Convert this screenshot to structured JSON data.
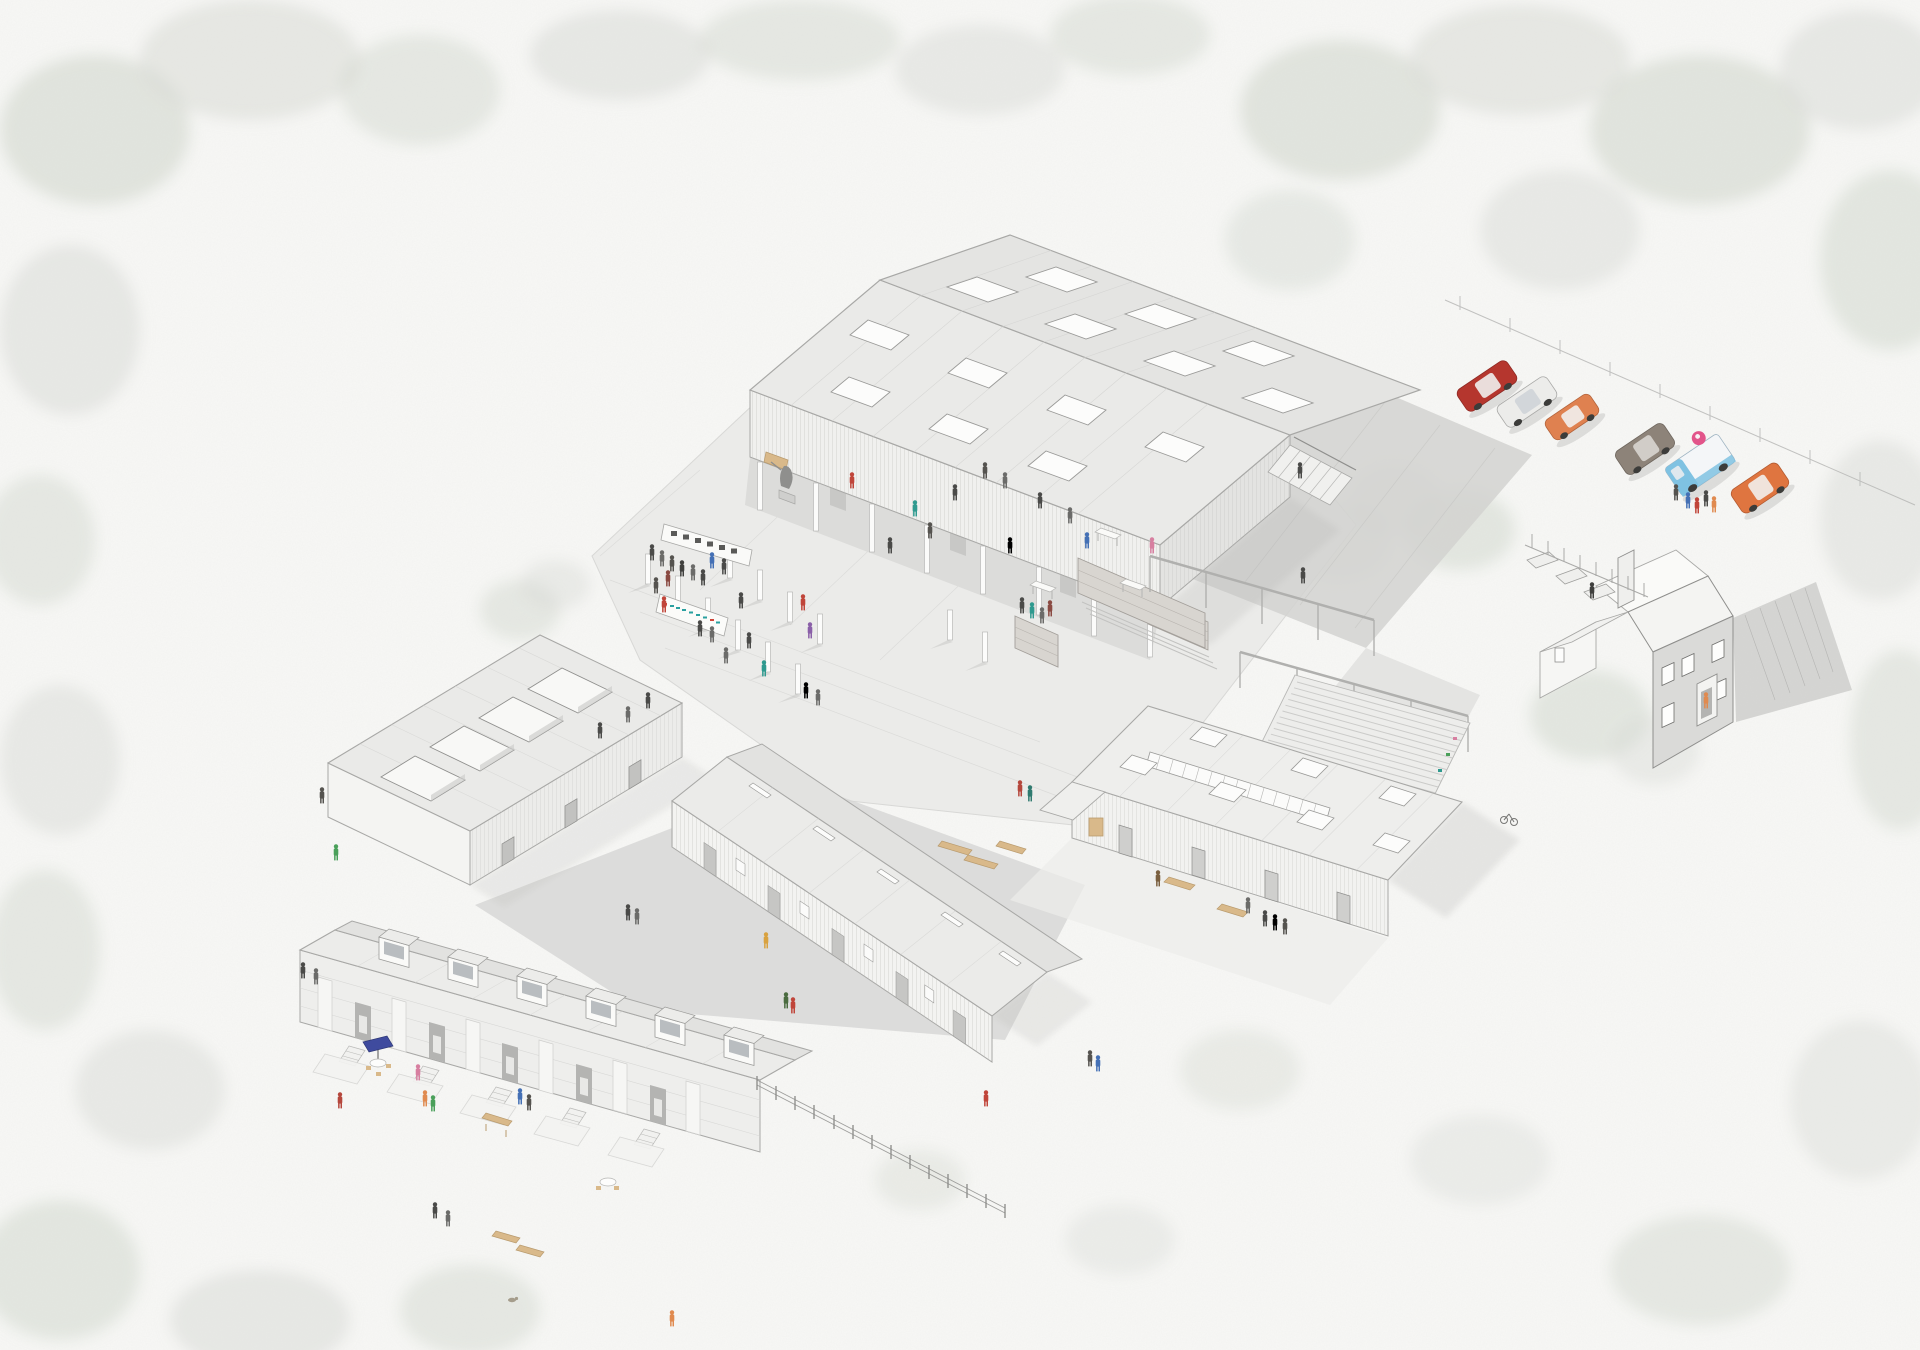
{
  "scene": {
    "type": "architectural-axonometric-illustration",
    "description": "Bird's-eye axonometric illustration of a converted farmstead campus: a large open-sided event barn over a public courtyard with exhibition walls, a sculpture and concrete post grid; a long workshop barn; a studio block with rectangular roof courtyards; a clerestory maker workshop with planting rows and a pergola walk; a terrace of barn houses with dormers, porches and patios; a farmhouse with kitchen garden; and a parking court with cars and an ice-cream van, all set in soft grey-green watercolour trees on white paper.",
    "style": "pale grey line drawing with selective colour accents"
  },
  "palette": {
    "paper": "#f7f7f5",
    "roof": "#eaeae8",
    "wall": "#f3f3f1",
    "wall_shaded": "#e2e2e0",
    "interior": "#dcdcda",
    "opening": "#c6c6c4",
    "paving": "#ebebe9",
    "drive": "#d2d2d0",
    "shadow": "#b3b3b1",
    "line": "#a8a8a6",
    "tree": "#ccd2c8",
    "tree_grey": "#d8dad5",
    "brick": "#d8d5d0"
  },
  "buildings": [
    {
      "id": "event-barn",
      "label": "Large event barn",
      "features": "gabled roof with 14 rooflights, open colonnade ground floor, right-side stair, brick stub wall"
    },
    {
      "id": "roof-court-studios",
      "label": "Studio block with roof courtyards",
      "features": "four rectangular roof openings, three door openings"
    },
    {
      "id": "workshop-barn",
      "label": "Long workshop barn",
      "features": "five doors, four windows, five ridge vents, timber stacks behind"
    },
    {
      "id": "maker-workshop",
      "label": "Clerestory maker workshop",
      "features": "ridge clerestory glazing, seven rooflights, four batten doors, benches and kiosk"
    },
    {
      "id": "terraced-houses",
      "label": "Terraced barn houses",
      "features": "six dormers, five porches with steps, patios with umbrella, picnic bench and table"
    },
    {
      "id": "farmhouse",
      "label": "Farmhouse",
      "features": "chimney, porch with figure, kitchen garden beds, long cast shadow"
    }
  ],
  "site": {
    "courtyard": {
      "label": "Central courtyard",
      "features": "concrete post grid, exhibition wall with small pictures, coloured sign wall, sculpture on plinth, cafe tables, brick walls, steps"
    },
    "parking": {
      "label": "Parking court",
      "vehicle_count": 6
    },
    "pergola": {
      "label": "Timber pergola walk",
      "beams": 2
    },
    "growing_rows": {
      "label": "Planting rows / cold frames",
      "row_count": 12
    },
    "fences": [
      "post-and-rail fence along bottom path",
      "garden fence at farmhouse",
      "boundary fence behind parking"
    ],
    "landscape": "soft grey-green watercolour tree masses and speckled grass"
  },
  "vehicles": [
    {
      "name": "red saloon car",
      "color": "#b5362e"
    },
    {
      "name": "white coupe",
      "color": "#ececea"
    },
    {
      "name": "orange hatchback",
      "color": "#df8150"
    },
    {
      "name": "grey-brown suv",
      "color": "#8d8379"
    },
    {
      "name": "ice-cream van",
      "color": "#7fc2e2",
      "accent": "#e2548a"
    },
    {
      "name": "orange suv",
      "color": "#df7540"
    }
  ],
  "accents": {
    "umbrella": "#3f4b9e",
    "sign_teal": "#2aa0a0",
    "sign_red": "#cf4437",
    "timber": "#d9b98a",
    "bench": "#d9b98a"
  },
  "figures": {
    "approx_count": 66,
    "clothing_colors": [
      "#4a4a48",
      "#6b6b69",
      "#c0453a",
      "#2f9a8f",
      "#4470b5",
      "#e08a4f",
      "#4aa05a",
      "#d77fa0",
      "#8a5fa8",
      "#d9a23f"
    ]
  }
}
